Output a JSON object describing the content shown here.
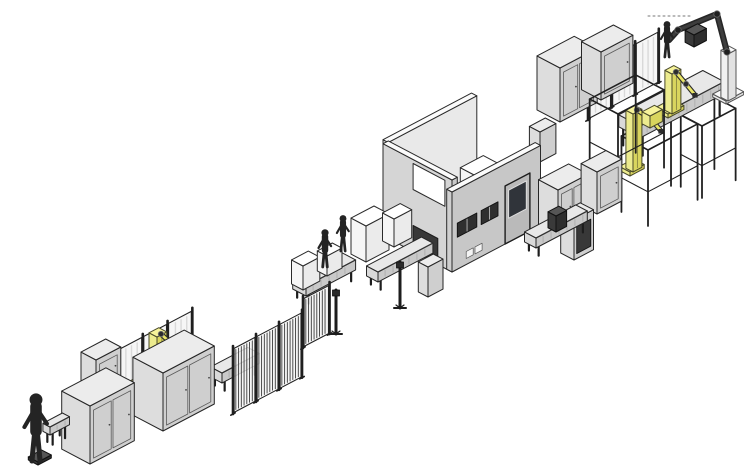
{
  "page": {
    "width": 744,
    "height": 475,
    "background": "#ffffff"
  },
  "illustration": {
    "palette": {
      "background": "#ffffff",
      "outline": "#262626",
      "machine_top": "#ececec",
      "machine_left": "#dddddd",
      "machine_right": "#cfcfcf",
      "white_top": "#ffffff",
      "white_left": "#f6f6f6",
      "white_right": "#ebebeb",
      "dark_top": "#565656",
      "dark_left": "#3a3a3a",
      "dark_right": "#2e2e2e",
      "wall_outer": "#d5d5d5",
      "wall_front": "#c7c7c7",
      "wall_inner": "#e9e9e9",
      "wall_top": "#fbfbfb",
      "floor": "#f6f6f6",
      "fence_fill": "#f4f4f4",
      "fence_frame": "#1f1f1f",
      "robot_yellow": "#eceb8e",
      "robot_yellow_bright": "#f6f39a",
      "robot_yellow_deep": "#d9d55e",
      "robot_joint": "#2c2c2c",
      "figure": "#242424",
      "metal_dark": "#1d1d1d",
      "conveyor_top": "#e8e8e8",
      "conveyor_left": "#d9d9d9",
      "conveyor_right": "#c9c9c9",
      "door_window": "#30343a",
      "door_fill": "#bababa"
    },
    "elements": [
      {
        "name": "gantry-frame-a",
        "type": "frame",
        "c": [
          648,
          226
        ],
        "l": 56,
        "d": 30,
        "h": 76
      },
      {
        "name": "gantry-frame-b",
        "type": "frame",
        "c": [
          702,
          198
        ],
        "l": 38,
        "d": 24,
        "h": 72
      },
      {
        "name": "topright-safety-fence",
        "type": "fence",
        "c": [
          588,
          120
        ],
        "len": 80,
        "h": 52,
        "panels": 3,
        "slatted": false
      },
      {
        "name": "topright-elevated-conveyor",
        "type": "conveyor",
        "c": [
          640,
          158
        ],
        "len": 95,
        "d": 24,
        "h": 12,
        "z0": 20
      },
      {
        "name": "topright-yellow-robot",
        "type": "robot",
        "plate": {
          "c": [
            668,
            118
          ],
          "l": 18,
          "d": 14
        },
        "pedestal": {
          "c": [
            672,
            114
          ],
          "l": 10,
          "d": 8,
          "h": 40
        },
        "arm": [
          [
            676,
            72
          ],
          [
            686,
            84
          ],
          [
            695,
            95
          ]
        ]
      },
      {
        "name": "ceiling-robot",
        "type": "tallrobot",
        "plate": {
          "c": [
            726,
            104
          ],
          "l": 20,
          "d": 15
        },
        "column": {
          "c": [
            728,
            101
          ],
          "l": 9,
          "d": 8,
          "h": 47
        },
        "arm": [
          [
            727,
            52
          ],
          [
            717,
            14
          ],
          [
            678,
            30
          ],
          [
            669,
            40
          ]
        ],
        "laser": [
          [
            690,
            16
          ],
          [
            646,
            16
          ]
        ]
      },
      {
        "name": "topright-operator",
        "type": "figure",
        "feet": [
          667,
          57
        ],
        "h": 36
      },
      {
        "name": "topright-conveyor-box",
        "type": "box",
        "c": [
          694,
          47
        ],
        "l": 14,
        "d": 10,
        "h": 12,
        "style": "dark"
      },
      {
        "name": "cluster-cabinet-a",
        "type": "box",
        "c": [
          560,
          122
        ],
        "l": 42,
        "d": 26,
        "h": 54,
        "style": "machine",
        "doors": 2
      },
      {
        "name": "cluster-cabinet-b",
        "type": "box",
        "c": [
          601,
          100
        ],
        "l": 36,
        "d": 22,
        "h": 48,
        "style": "machine",
        "doors": 1
      },
      {
        "name": "cluster-cabinet-back",
        "type": "box",
        "c": [
          540,
          162
        ],
        "l": 18,
        "d": 12,
        "h": 30,
        "style": "machine"
      },
      {
        "name": "gantry-yellow-robot",
        "type": "robot",
        "plate": {
          "c": [
            630,
            176
          ],
          "l": 16,
          "d": 12
        },
        "pedestal": {
          "c": [
            633,
            172
          ],
          "l": 10,
          "d": 8,
          "h": 58
        },
        "arm": [
          [
            637,
            110
          ],
          [
            651,
            119
          ],
          [
            661,
            131
          ]
        ]
      },
      {
        "name": "gantry-yellow-carriage",
        "type": "box",
        "c": [
          650,
          128
        ],
        "l": 14,
        "d": 9,
        "h": 12,
        "style": "yellow"
      },
      {
        "name": "cluster-frame",
        "type": "frame",
        "c": [
          618,
          192
        ],
        "l": 52,
        "d": 32,
        "h": 78
      },
      {
        "name": "enclosure-room",
        "type": "room",
        "c": [
          452,
          272
        ],
        "len": 100,
        "depth": 78,
        "wallT": 6,
        "hLeft": 92,
        "hFront": 80,
        "hBack": 96,
        "leftWindow": {
          "u": [
            8,
            44
          ],
          "v": [
            62,
            88
          ]
        },
        "tunnel": {
          "u": [
            16,
            44
          ],
          "v": [
            0,
            26
          ]
        },
        "slots": [
          {
            "u": [
              6,
              28
            ],
            "v": [
              32,
              46
            ]
          },
          {
            "u": [
              33,
              52
            ],
            "v": [
              32,
              46
            ]
          }
        ],
        "door": {
          "u": [
            60,
            88
          ],
          "v": [
            0,
            58
          ],
          "win": {
            "u": [
              64,
              84
            ],
            "v": [
              24,
              52
            ]
          }
        },
        "vents": [
          {
            "u": [
              16,
              24
            ],
            "v": [
              6,
              13
            ]
          },
          {
            "u": [
              26,
              34
            ],
            "v": [
              6,
              13
            ]
          }
        ],
        "interiorBoxes": [
          {
            "c": [
              478,
              219
            ],
            "l": 26,
            "d": 20,
            "h": 42
          },
          {
            "c": [
              450,
              233
            ],
            "l": 18,
            "d": 14,
            "h": 28
          }
        ],
        "interiorRobot": {
          "base": {
            "c": [
              418,
              201
            ],
            "l": 9,
            "d": 7,
            "h": 12
          },
          "arm": [
            [
              417,
              196
            ],
            [
              433,
              203
            ],
            [
              447,
              213
            ]
          ]
        }
      },
      {
        "name": "cluster-cabinet-c",
        "type": "box",
        "c": [
          558,
          236
        ],
        "l": 34,
        "d": 22,
        "h": 46,
        "style": "machine",
        "doors": 2
      },
      {
        "name": "cluster-cabinet-d",
        "type": "box",
        "c": [
          597,
          214
        ],
        "l": 28,
        "d": 18,
        "h": 42,
        "style": "machine",
        "doors": 1
      },
      {
        "name": "cluster-cabinet-e",
        "type": "box",
        "c": [
          574,
          260
        ],
        "l": 22,
        "d": 15,
        "h": 40,
        "style": "machine",
        "darkPanel": true
      },
      {
        "name": "link-conveyor",
        "type": "conveyor",
        "c": [
          536,
          258
        ],
        "len": 58,
        "d": 13,
        "h": 10,
        "z0": 10
      },
      {
        "name": "link-conveyor-box",
        "type": "box",
        "c": [
          556,
          232
        ],
        "l": 12,
        "d": 9,
        "h": 16,
        "style": "dark"
      },
      {
        "name": "tunnel-conveyor",
        "type": "conveyor",
        "c": [
          378,
          292
        ],
        "len": 62,
        "d": 13,
        "h": 10,
        "z0": 10
      },
      {
        "name": "staging-box-a",
        "type": "box",
        "c": [
          366,
          262
        ],
        "l": 26,
        "d": 17,
        "h": 36,
        "style": "white"
      },
      {
        "name": "staging-box-b",
        "type": "box",
        "c": [
          394,
          247
        ],
        "l": 20,
        "d": 13,
        "h": 28,
        "style": "white"
      },
      {
        "name": "staging-small-cabinet",
        "type": "box",
        "c": [
          428,
          297
        ],
        "l": 17,
        "d": 11,
        "h": 30,
        "style": "machine"
      },
      {
        "name": "stand-post-a",
        "type": "post",
        "c": [
          400,
          308
        ],
        "h": 46
      },
      {
        "name": "workstation-conveyor",
        "type": "conveyor",
        "c": [
          306,
          306
        ],
        "len": 56,
        "d": 15,
        "h": 10,
        "z0": 10
      },
      {
        "name": "workstation-table-a",
        "type": "box",
        "c": [
          303,
          290
        ],
        "l": 19,
        "d": 13,
        "h": 24,
        "style": "white"
      },
      {
        "name": "workstation-table-b",
        "type": "box",
        "c": [
          327,
          276
        ],
        "l": 17,
        "d": 11,
        "h": 20,
        "style": "white"
      },
      {
        "name": "operator-a",
        "type": "figure",
        "feet": [
          325,
          267
        ],
        "h": 38
      },
      {
        "name": "operator-b",
        "type": "figure",
        "feet": [
          343,
          251
        ],
        "h": 36
      },
      {
        "name": "stand-post-b",
        "type": "post",
        "c": [
          336,
          334
        ],
        "h": 44
      },
      {
        "name": "line-conveyor-2",
        "type": "conveyor",
        "c": [
          222,
          393
        ],
        "len": 42,
        "d": 13,
        "h": 10,
        "z0": 10
      },
      {
        "name": "slat-fence-a",
        "type": "fence",
        "c": [
          233,
          414
        ],
        "len": 78,
        "h": 66,
        "panels": 3,
        "slatted": true
      },
      {
        "name": "slat-fence-b",
        "type": "fence",
        "c": [
          303,
          348
        ],
        "len": 30,
        "h": 50,
        "panels": 1,
        "slatted": true
      },
      {
        "name": "cell-back-fence",
        "type": "fence",
        "c": [
          118,
          413
        ],
        "len": 84,
        "h": 64,
        "panels": 3,
        "slatted": false
      },
      {
        "name": "cell-back-cabinet",
        "type": "box",
        "c": [
          96,
          392
        ],
        "l": 28,
        "d": 17,
        "h": 32,
        "style": "machine",
        "doors": 1
      },
      {
        "name": "cell-robot",
        "type": "robot",
        "plate": {
          "c": [
            150,
            395
          ],
          "l": 30,
          "d": 22
        },
        "pedestal": {
          "c": [
            157,
            389
          ],
          "l": 11,
          "d": 9,
          "h": 52
        },
        "arm": [
          [
            161,
            334
          ],
          [
            176,
            348
          ],
          [
            196,
            363
          ]
        ]
      },
      {
        "name": "infeed-cabinet-b",
        "type": "box",
        "c": [
          163,
          431
        ],
        "l": 58,
        "d": 34,
        "h": 58,
        "style": "machine",
        "doors": 2
      },
      {
        "name": "infeed-cabinet-a",
        "type": "box",
        "c": [
          90,
          464
        ],
        "l": 50,
        "d": 32,
        "h": 58,
        "style": "machine",
        "doors": 2
      },
      {
        "name": "start-conveyor",
        "type": "conveyor",
        "c": [
          50,
          447
        ],
        "len": 22,
        "d": 8,
        "h": 8,
        "z0": 12
      },
      {
        "name": "start-operator-base",
        "type": "box",
        "c": [
          38,
          465
        ],
        "l": 15,
        "d": 11,
        "h": 3,
        "style": "dark"
      },
      {
        "name": "start-operator",
        "type": "figure",
        "feet": [
          36,
          461
        ],
        "h": 68
      }
    ]
  }
}
